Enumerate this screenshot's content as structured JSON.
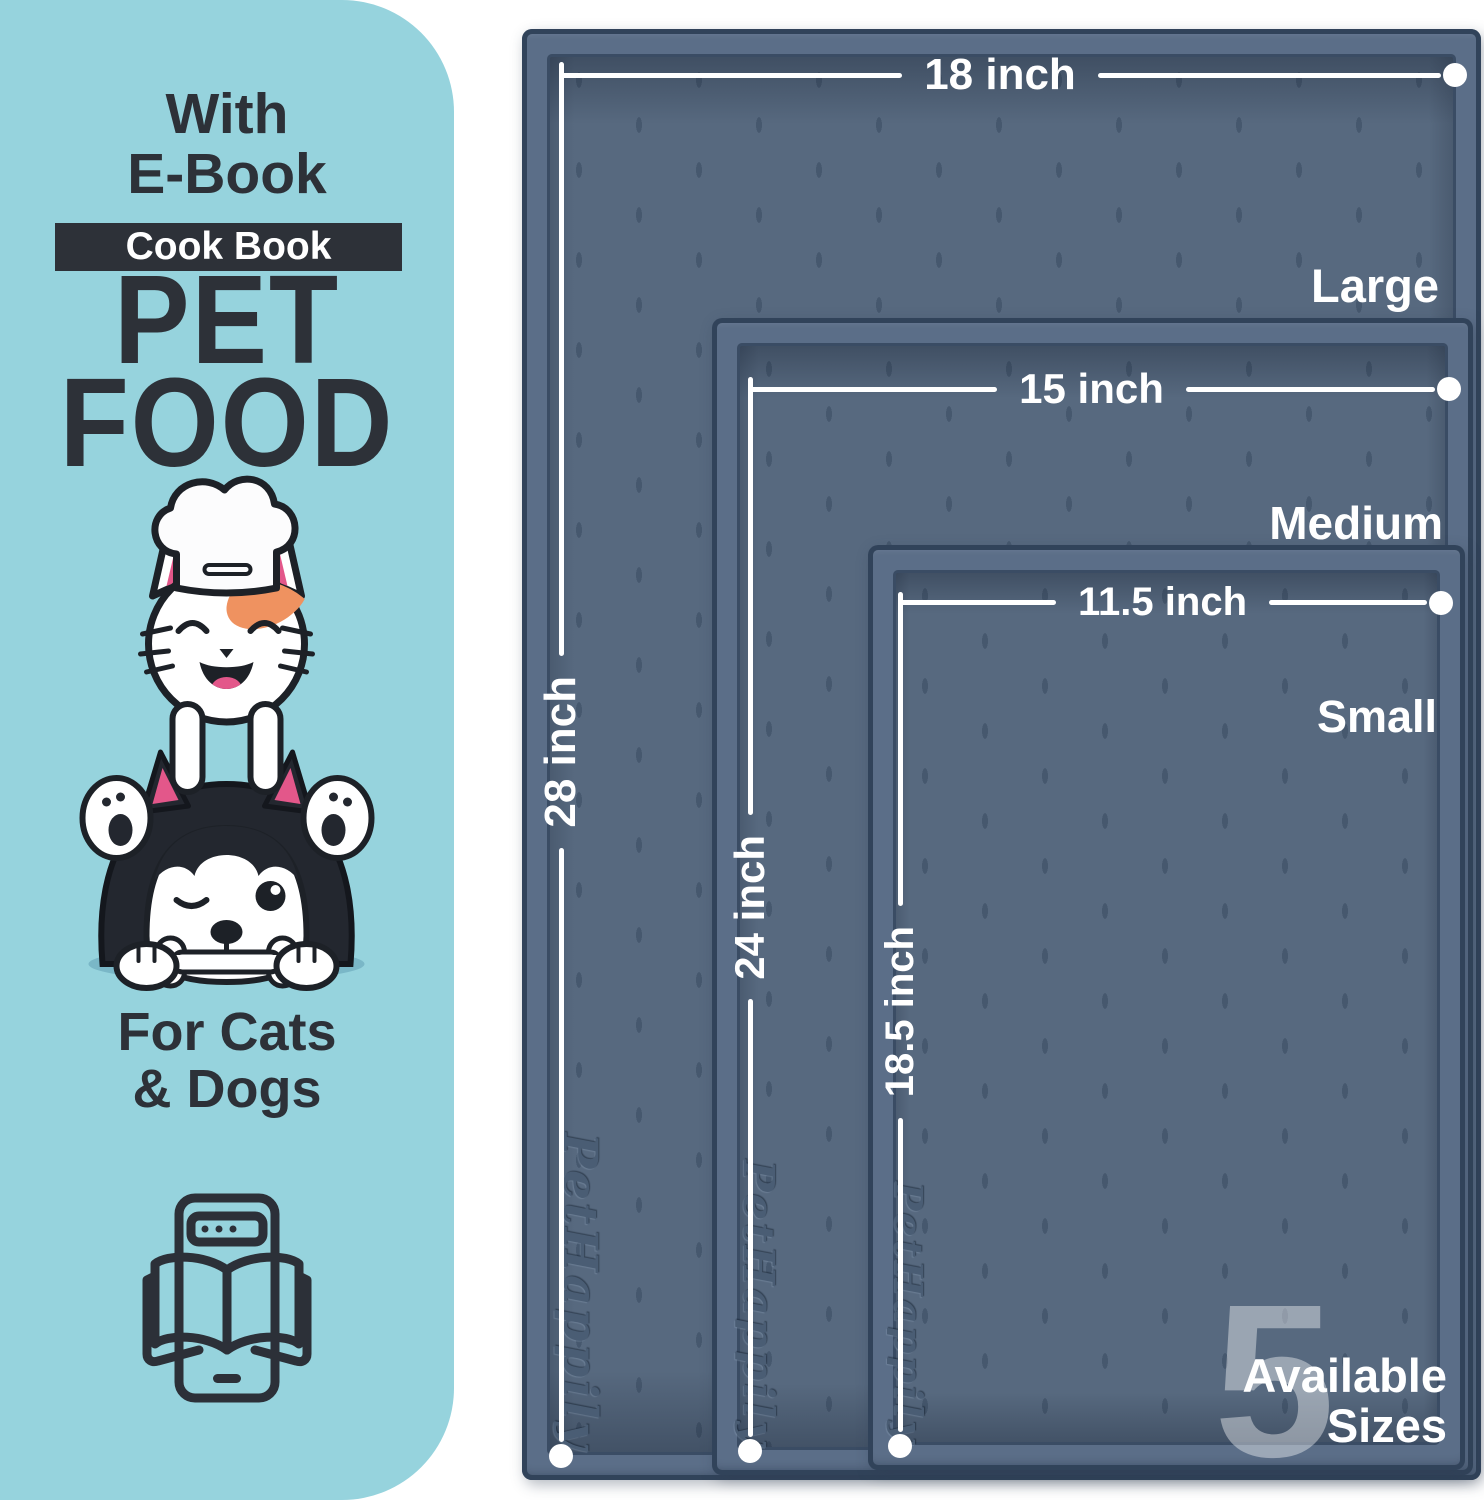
{
  "panel": {
    "top_line1": "With",
    "top_line2": "E-Book",
    "badge_label": "Cook Book",
    "title_line1": "PET",
    "title_line2": "FOOD",
    "subtitle_line1": "For Cats",
    "subtitle_line2": "& Dogs",
    "illustration": "cat-chef-on-husky-dog-with-bone",
    "icon": "ebook-tablet-open-book-icon"
  },
  "mats": [
    {
      "size_name": "Large",
      "width_label": "18 inch",
      "length_label": "28 inch",
      "brand_emboss": "PetHappily"
    },
    {
      "size_name": "Medium",
      "width_label": "15 inch",
      "length_label": "24 inch",
      "brand_emboss": "PetHappily"
    },
    {
      "size_name": "Small",
      "width_label": "11.5 inch",
      "length_label": "18.5 inch",
      "brand_emboss": "PetHappily"
    }
  ],
  "sizes_badge": {
    "number": "5",
    "line1": "Available",
    "line2": "Sizes"
  },
  "colors": {
    "panel_bg": "#96d3dd",
    "ink": "#2d3138",
    "badge_bg": "#2d3138",
    "badge_text": "#ffffff",
    "mat_surface": "#57697f",
    "mat_rim": "#5b6e88",
    "mat_edge": "#31435a",
    "measure_line": "#ffffff",
    "accent_orange": "#ef9260",
    "accent_pink": "#e3578a",
    "shadow_teal": "#7ab7c7"
  }
}
